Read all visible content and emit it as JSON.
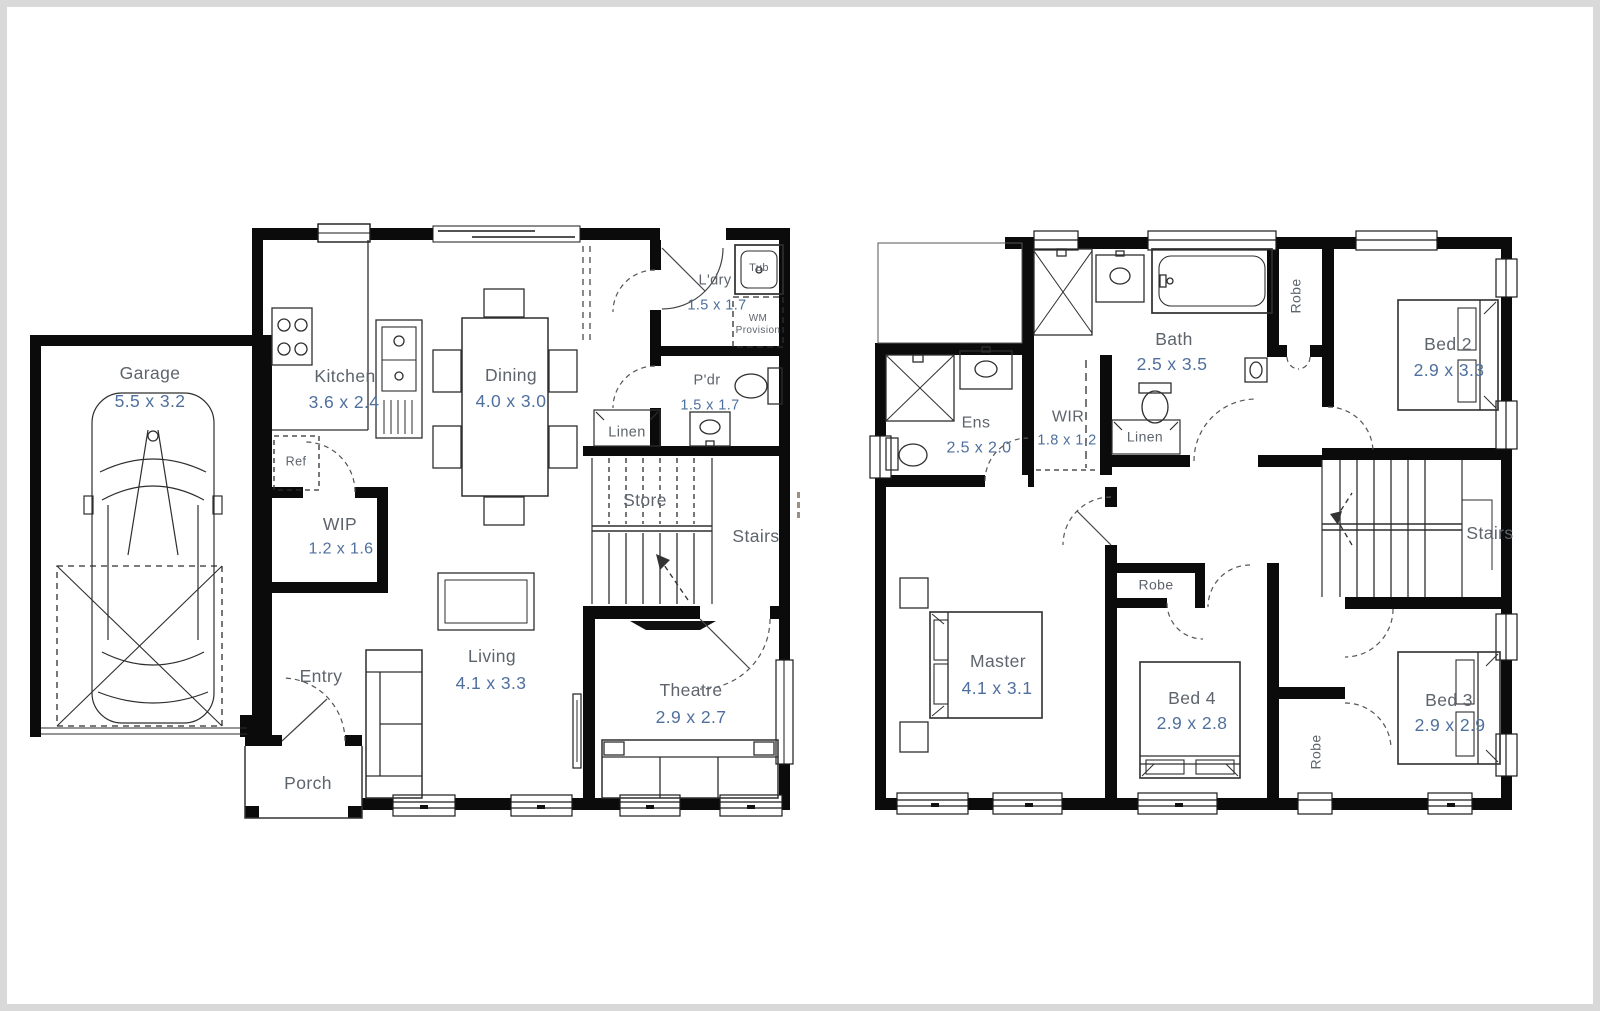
{
  "plan": {
    "ground_floor": {
      "rooms": {
        "garage": {
          "name": "Garage",
          "dims": "5.5 x 3.2"
        },
        "kitchen": {
          "name": "Kitchen",
          "dims": "3.6 x 2.4"
        },
        "dining": {
          "name": "Dining",
          "dims": "4.0 x 3.0"
        },
        "laundry": {
          "name": "L'dry",
          "dims": "1.5 x 1.7"
        },
        "powder": {
          "name": "P'dr",
          "dims": "1.5 x 1.7"
        },
        "wip": {
          "name": "WIP",
          "dims": "1.2 x 1.6"
        },
        "living": {
          "name": "Living",
          "dims": "4.1 x 3.3"
        },
        "theatre": {
          "name": "Theatre",
          "dims": "2.9 x 2.7"
        },
        "store": {
          "name": "Store"
        },
        "stairs": {
          "name": "Stairs"
        },
        "linen": {
          "name": "Linen"
        },
        "entry": {
          "name": "Entry"
        },
        "porch": {
          "name": "Porch"
        },
        "fridge": {
          "name": "Ref"
        },
        "tub": {
          "name": "Tub"
        },
        "wm_provision": {
          "line1": "WM",
          "line2": "Provision"
        }
      }
    },
    "first_floor": {
      "rooms": {
        "ensuite": {
          "name": "Ens",
          "dims": "2.5 x 2.0"
        },
        "wir": {
          "name": "WIR",
          "dims": "1.8 x 1.2"
        },
        "bath": {
          "name": "Bath",
          "dims": "2.5 x 3.5"
        },
        "linen": {
          "name": "Linen"
        },
        "robe_top": {
          "name": "Robe"
        },
        "bed2": {
          "name": "Bed 2",
          "dims": "2.9 x 3.3"
        },
        "master": {
          "name": "Master",
          "dims": "4.1 x 3.1"
        },
        "robe_mid": {
          "name": "Robe"
        },
        "bed4": {
          "name": "Bed 4",
          "dims": "2.9 x 2.8"
        },
        "bed3": {
          "name": "Bed 3",
          "dims": "2.9 x 2.9"
        },
        "robe_bottom": {
          "name": "Robe"
        },
        "stairs": {
          "name": "Stairs"
        }
      }
    },
    "icons": [
      "car-icon",
      "stove-icon",
      "sink-icon",
      "fridge-icon",
      "dining-table-icon",
      "sofa-icon",
      "coffee-table-icon",
      "tv-icon",
      "theatre-screen-icon",
      "laundry-tub-icon",
      "toilet-icon",
      "basin-icon",
      "bathtub-icon",
      "shower-icon",
      "bed-icon",
      "stairs-icon",
      "window-icon",
      "door-swing-icon"
    ],
    "colors": {
      "walls": "#0b0b0b",
      "room_labels": "#5d646c",
      "dimension_labels": "#4f6f9d",
      "frame": "#d9d9d9",
      "background": "#ffffff"
    }
  }
}
